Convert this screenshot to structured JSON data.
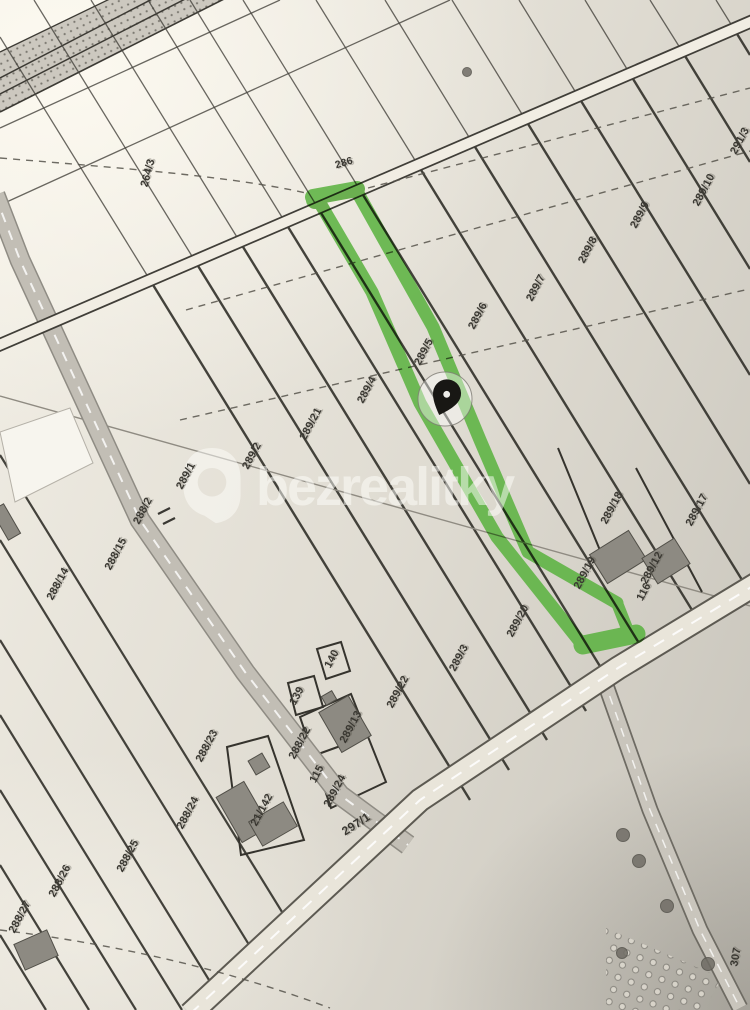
{
  "map": {
    "watermark": {
      "text": "bezrealitky"
    },
    "highlight_color": "#58b13d",
    "highlighted_parcel": "289/5",
    "marker": {
      "name": "location-pin",
      "x": 445,
      "y": 399
    },
    "paper_color": "#e6e2d8",
    "line_color": "#35332d",
    "labels": [
      {
        "t": "264/3",
        "x": 148,
        "y": 173,
        "r": -75
      },
      {
        "t": "286",
        "x": 344,
        "y": 163,
        "r": -17,
        "s": 10.5
      },
      {
        "t": "291/3",
        "x": 740,
        "y": 141,
        "r": -62
      },
      {
        "t": "289/10",
        "x": 704,
        "y": 190,
        "r": -62
      },
      {
        "t": "289/9",
        "x": 640,
        "y": 215,
        "r": -62
      },
      {
        "t": "289/8",
        "x": 588,
        "y": 250,
        "r": -62
      },
      {
        "t": "289/7",
        "x": 536,
        "y": 288,
        "r": -62
      },
      {
        "t": "289/6",
        "x": 478,
        "y": 316,
        "r": -62
      },
      {
        "t": "289/5",
        "x": 424,
        "y": 352,
        "r": -62
      },
      {
        "t": "289/4",
        "x": 367,
        "y": 390,
        "r": -62
      },
      {
        "t": "289/21",
        "x": 311,
        "y": 424,
        "r": -62
      },
      {
        "t": "289/2",
        "x": 252,
        "y": 456,
        "r": -62
      },
      {
        "t": "289/1",
        "x": 186,
        "y": 476,
        "r": -62
      },
      {
        "t": "288/2",
        "x": 143,
        "y": 511,
        "r": -62
      },
      {
        "t": "288/15",
        "x": 116,
        "y": 554,
        "r": -62
      },
      {
        "t": "288/14",
        "x": 58,
        "y": 584,
        "r": -62
      },
      {
        "t": "289/18",
        "x": 612,
        "y": 508,
        "r": -62
      },
      {
        "t": "289/17",
        "x": 697,
        "y": 510,
        "r": -62
      },
      {
        "t": "289/12",
        "x": 652,
        "y": 568,
        "r": -62
      },
      {
        "t": "116",
        "x": 644,
        "y": 592,
        "r": -62
      },
      {
        "t": "289/19",
        "x": 585,
        "y": 573,
        "r": -62
      },
      {
        "t": "289/20",
        "x": 518,
        "y": 621,
        "r": -62
      },
      {
        "t": "289/3",
        "x": 459,
        "y": 658,
        "r": -62
      },
      {
        "t": "289/22",
        "x": 398,
        "y": 692,
        "r": -62
      },
      {
        "t": "140",
        "x": 332,
        "y": 659,
        "r": -62
      },
      {
        "t": "139",
        "x": 297,
        "y": 696,
        "r": -62
      },
      {
        "t": "289/13",
        "x": 351,
        "y": 727,
        "r": -62
      },
      {
        "t": "288/22",
        "x": 300,
        "y": 743,
        "r": -62
      },
      {
        "t": "115",
        "x": 317,
        "y": 774,
        "r": -62
      },
      {
        "t": "289/24",
        "x": 335,
        "y": 791,
        "r": -62
      },
      {
        "t": "288/23",
        "x": 207,
        "y": 746,
        "r": -62
      },
      {
        "t": "21/142",
        "x": 262,
        "y": 810,
        "r": -62
      },
      {
        "t": "288/24",
        "x": 188,
        "y": 813,
        "r": -62
      },
      {
        "t": "288/25",
        "x": 128,
        "y": 856,
        "r": -62
      },
      {
        "t": "288/26",
        "x": 60,
        "y": 881,
        "r": -62
      },
      {
        "t": "288/27",
        "x": 20,
        "y": 917,
        "r": -62
      },
      {
        "t": "297/1",
        "x": 356,
        "y": 824,
        "r": -33,
        "s": 12
      },
      {
        "t": "307",
        "x": 736,
        "y": 957,
        "r": -80
      }
    ]
  }
}
